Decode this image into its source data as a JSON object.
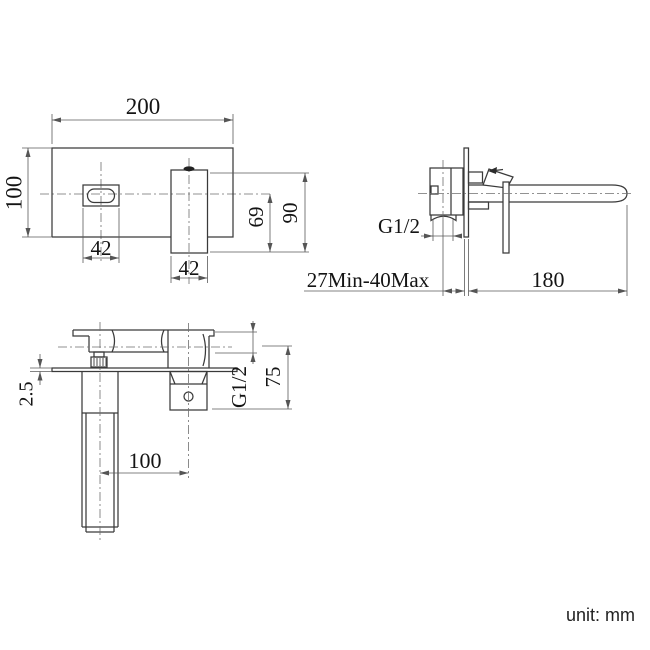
{
  "drawing": {
    "title": "wall-mounted basin mixer dimension drawing",
    "unit_label": "unit: mm",
    "colors": {
      "line": "#3a3a3a",
      "dim_line": "#5a5a5a",
      "text": "#141414"
    },
    "front_view": {
      "plate_width": "200",
      "plate_height": "100",
      "spout_opening_width": "42",
      "handle_width": "42",
      "center_to_handle_bottom": "69",
      "handle_height": "90"
    },
    "side_view": {
      "inlet_thread": "G1/2",
      "wall_thickness_range": "27Min-40Max",
      "spout_reach": "180"
    },
    "top_view": {
      "plate_thickness": "2.5",
      "spout_to_valve_distance": "100",
      "inlet_thread": "G1/2",
      "body_depth": "75"
    }
  }
}
